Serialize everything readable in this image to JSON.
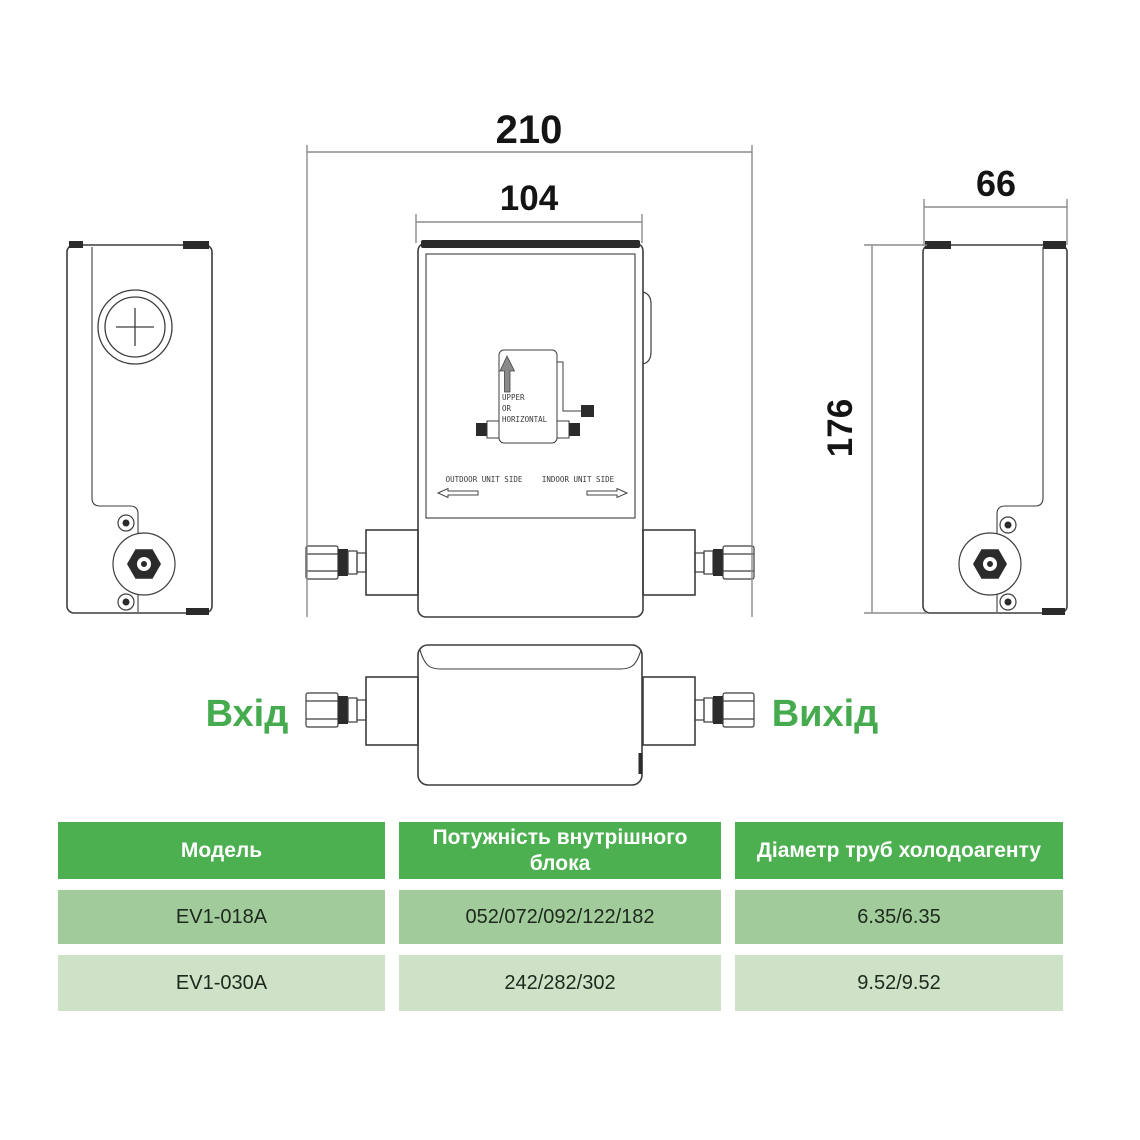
{
  "dimensions": {
    "total_width": "210",
    "body_width": "104",
    "depth": "66",
    "height": "176"
  },
  "ports": {
    "inlet": "Вхід",
    "outlet": "Вихід"
  },
  "drawing_labels": {
    "orientation_line1": "UPPER",
    "orientation_line2": "OR",
    "orientation_line3": "HORIZONTAL",
    "outdoor_side": "OUTDOOR UNIT SIDE",
    "indoor_side": "INDOOR UNIT SIDE"
  },
  "table": {
    "headers": [
      "Модель",
      "Потужність внутрішного блока",
      "Діаметр труб холодоагенту"
    ],
    "rows": [
      [
        "EV1-018A",
        "052/072/092/122/182",
        "6.35/6.35"
      ],
      [
        "EV1-030A",
        "242/282/302",
        "9.52/9.52"
      ]
    ]
  },
  "colors": {
    "accent_green": "#45ab4e",
    "header_green": "#4caf50",
    "row1_green": "#a2cb9b",
    "row2_green": "#cde2c6"
  }
}
